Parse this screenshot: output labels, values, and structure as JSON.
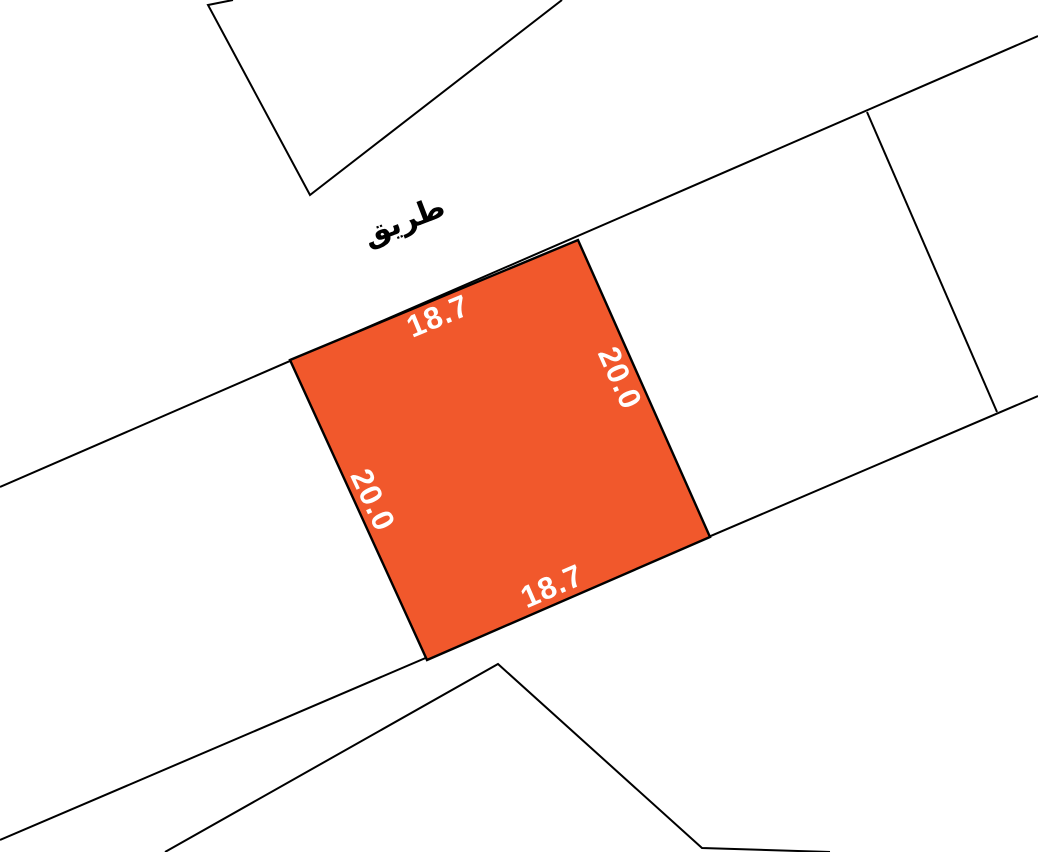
{
  "map": {
    "road_label": "طريق",
    "colors": {
      "highlight": "#F1582C",
      "line": "#000000",
      "background": "#FFFFFF",
      "dimension_text": "#FFFFFF",
      "road_text": "#000000"
    },
    "parcel": {
      "top_length": "18.7",
      "right_length": "20.0",
      "bottom_length": "18.7",
      "left_length": "20.0"
    }
  }
}
